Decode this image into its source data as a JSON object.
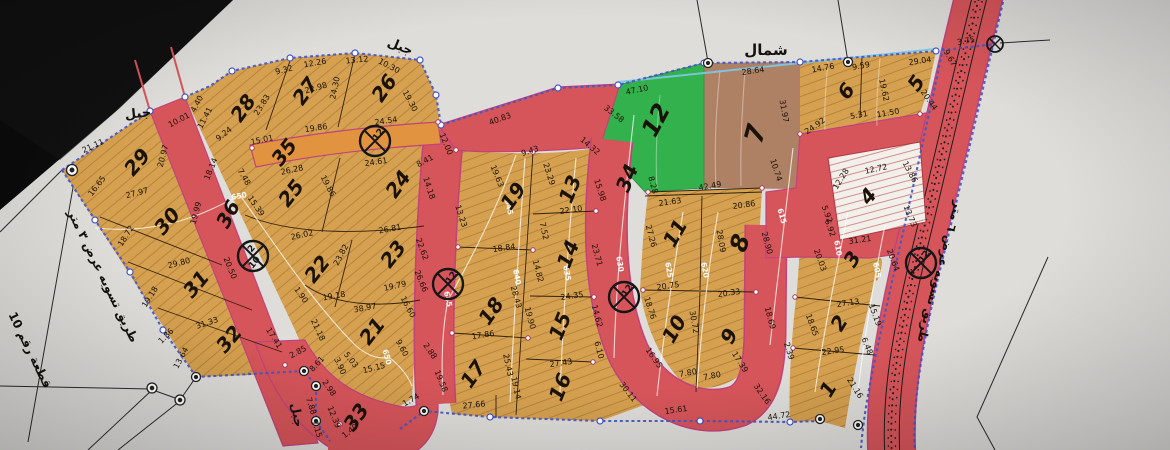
{
  "map": {
    "type": "cadastral-subdivision-plan",
    "north_label": "شمال",
    "colors": {
      "paper": "#deddda",
      "black_corner": "#0b0b0c",
      "plot_tan": "#d5a04f",
      "road_red": "#d6555a",
      "road_edge_magenta": "#c2427c",
      "road_orange": "#e2933f",
      "plot_green": "#33b14c",
      "plot_brown": "#ae8165",
      "plot_hatched_white": "#f3f0ec",
      "boundary_blue": "#4456c7",
      "contour_white": "#ffffff",
      "ink": "#1a1208"
    },
    "labels": [
      {
        "t": "شمال",
        "x": 766,
        "y": 50,
        "r": 0,
        "s": 15,
        "b": 1
      },
      {
        "t": "جبل",
        "x": 400,
        "y": 47,
        "r": 22,
        "s": 13,
        "b": 1
      },
      {
        "t": "جبل",
        "x": 138,
        "y": 114,
        "r": -6,
        "s": 13,
        "b": 1
      },
      {
        "t": "جبل",
        "x": 297,
        "y": 415,
        "r": 80,
        "s": 12,
        "b": 1
      },
      {
        "t": "طريق تسويه عرض ٣ متر",
        "x": 103,
        "y": 276,
        "r": 64,
        "s": 12,
        "b": 1
      },
      {
        "t": "قطعة رقم 10",
        "x": 30,
        "y": 350,
        "r": 64,
        "s": 12,
        "b": 1
      },
      {
        "t": "طريق تسويه عرض ٦ متر",
        "x": 940,
        "y": 272,
        "r": 105,
        "s": 12,
        "b": 1
      }
    ],
    "plots": [
      {
        "n": "1",
        "x": 828,
        "y": 389,
        "r": -58
      },
      {
        "n": "2",
        "x": 839,
        "y": 323,
        "r": -58
      },
      {
        "n": "3",
        "x": 852,
        "y": 259,
        "r": -58
      },
      {
        "n": "4",
        "x": 868,
        "y": 196,
        "r": -50
      },
      {
        "n": "5",
        "x": 916,
        "y": 83,
        "r": -55
      },
      {
        "n": "6",
        "x": 846,
        "y": 91,
        "r": -52
      },
      {
        "n": "7",
        "x": 756,
        "y": 134,
        "r": -75,
        "s": 26
      },
      {
        "n": "8",
        "x": 740,
        "y": 243,
        "r": -72,
        "s": 24
      },
      {
        "n": "9",
        "x": 729,
        "y": 336,
        "r": -62
      },
      {
        "n": "10",
        "x": 674,
        "y": 329,
        "r": -60
      },
      {
        "n": "11",
        "x": 675,
        "y": 233,
        "r": -60
      },
      {
        "n": "12",
        "x": 656,
        "y": 120,
        "r": -62,
        "s": 24
      },
      {
        "n": "13",
        "x": 570,
        "y": 189,
        "r": -68
      },
      {
        "n": "14",
        "x": 568,
        "y": 254,
        "r": -68
      },
      {
        "n": "15",
        "x": 560,
        "y": 326,
        "r": -68
      },
      {
        "n": "16",
        "x": 560,
        "y": 387,
        "r": -68
      },
      {
        "n": "17",
        "x": 473,
        "y": 374,
        "r": -55
      },
      {
        "n": "18",
        "x": 491,
        "y": 311,
        "r": -55
      },
      {
        "n": "19",
        "x": 513,
        "y": 196,
        "r": -55
      },
      {
        "n": "21",
        "x": 372,
        "y": 331,
        "r": -52
      },
      {
        "n": "22",
        "x": 317,
        "y": 269,
        "r": -52
      },
      {
        "n": "23",
        "x": 393,
        "y": 254,
        "r": -52
      },
      {
        "n": "24",
        "x": 398,
        "y": 184,
        "r": -55
      },
      {
        "n": "25",
        "x": 291,
        "y": 193,
        "r": -52
      },
      {
        "n": "26",
        "x": 384,
        "y": 88,
        "r": -55
      },
      {
        "n": "27",
        "x": 305,
        "y": 91,
        "r": -55
      },
      {
        "n": "28",
        "x": 243,
        "y": 108,
        "r": -55
      },
      {
        "n": "29",
        "x": 137,
        "y": 162,
        "r": -50
      },
      {
        "n": "30",
        "x": 167,
        "y": 221,
        "r": -50
      },
      {
        "n": "31",
        "x": 196,
        "y": 284,
        "r": -50
      },
      {
        "n": "32",
        "x": 229,
        "y": 339,
        "r": -50
      },
      {
        "n": "33",
        "x": 356,
        "y": 417,
        "r": -55
      },
      {
        "n": "34",
        "x": 627,
        "y": 178,
        "r": -68
      },
      {
        "n": "35",
        "x": 284,
        "y": 152,
        "r": -52
      },
      {
        "n": "36",
        "x": 228,
        "y": 214,
        "r": -62
      }
    ],
    "dims": [
      [
        "21.11",
        93,
        146,
        -25
      ],
      [
        "4.40",
        197,
        104,
        -62
      ],
      [
        "11.41",
        205,
        118,
        -62
      ],
      [
        "9.24",
        224,
        134,
        -38
      ],
      [
        "22.98",
        316,
        88,
        -16
      ],
      [
        "9.32",
        284,
        70,
        -14
      ],
      [
        "12.26",
        315,
        63,
        -10
      ],
      [
        "13.12",
        357,
        60,
        -6
      ],
      [
        "10.30",
        389,
        66,
        28
      ],
      [
        "24.30",
        335,
        88,
        -78
      ],
      [
        "23.83",
        262,
        105,
        -58
      ],
      [
        "19.30",
        410,
        101,
        62
      ],
      [
        "24.54",
        386,
        121,
        -8
      ],
      [
        "19.86",
        316,
        128,
        -8
      ],
      [
        "15.01",
        262,
        140,
        -12
      ],
      [
        "10.01",
        179,
        120,
        -28
      ],
      [
        "20.97",
        163,
        156,
        -75
      ],
      [
        "18.14",
        211,
        169,
        -68
      ],
      [
        "16.65",
        97,
        186,
        -52
      ],
      [
        "27.97",
        137,
        193,
        -14
      ],
      [
        "19.99",
        196,
        213,
        -75
      ],
      [
        "18.72",
        126,
        236,
        -58
      ],
      [
        "29.80",
        179,
        263,
        -14
      ],
      [
        "19.18",
        150,
        297,
        -58
      ],
      [
        "31.33",
        207,
        323,
        -18
      ],
      [
        "1.86",
        166,
        336,
        -45
      ],
      [
        "13.64",
        181,
        358,
        -62
      ],
      [
        "20.50",
        230,
        268,
        68
      ],
      [
        "26.28",
        292,
        170,
        -12
      ],
      [
        "15.39",
        256,
        206,
        55
      ],
      [
        "7.48",
        244,
        177,
        60
      ],
      [
        "19.86",
        328,
        186,
        62
      ],
      [
        "24.61",
        376,
        162,
        -8
      ],
      [
        "8.41",
        425,
        161,
        -28
      ],
      [
        "14.18",
        429,
        188,
        72
      ],
      [
        "26.02",
        302,
        235,
        -12
      ],
      [
        "26.81",
        390,
        229,
        -10
      ],
      [
        "23.82",
        341,
        255,
        -62
      ],
      [
        "22.62",
        422,
        249,
        70
      ],
      [
        "19.79",
        395,
        286,
        -12
      ],
      [
        "19.18",
        334,
        296,
        -10
      ],
      [
        "1.90",
        301,
        295,
        55
      ],
      [
        "21.18",
        318,
        330,
        65
      ],
      [
        "38.97",
        365,
        308,
        -10
      ],
      [
        "16.60",
        408,
        307,
        62
      ],
      [
        "9.60",
        402,
        348,
        62
      ],
      [
        "15.15",
        374,
        368,
        -14
      ],
      [
        "5.03",
        351,
        360,
        52
      ],
      [
        "2.85",
        298,
        352,
        -28
      ],
      [
        "8.61",
        317,
        364,
        -48
      ],
      [
        "3.90",
        340,
        366,
        65
      ],
      [
        "2.98",
        329,
        388,
        55
      ],
      [
        "7.88",
        311,
        406,
        72
      ],
      [
        "7.15",
        317,
        429,
        72
      ],
      [
        "12.39",
        334,
        417,
        68
      ],
      [
        "1.40",
        350,
        431,
        -38
      ],
      [
        "1.74",
        411,
        400,
        -30
      ],
      [
        "17.41",
        274,
        338,
        58
      ],
      [
        "40.83",
        500,
        119,
        -20
      ],
      [
        "12.00",
        446,
        144,
        68
      ],
      [
        "9.43",
        530,
        151,
        -18
      ],
      [
        "14.32",
        590,
        146,
        40
      ],
      [
        "23.29",
        549,
        174,
        72
      ],
      [
        "19.63",
        497,
        176,
        68
      ],
      [
        "13.23",
        461,
        216,
        72
      ],
      [
        "15.98",
        600,
        190,
        72
      ],
      [
        "22.10",
        571,
        210,
        -8
      ],
      [
        "7.52",
        544,
        231,
        78
      ],
      [
        "18.84",
        504,
        248,
        -8
      ],
      [
        "23.71",
        597,
        255,
        75
      ],
      [
        "14.82",
        538,
        271,
        75
      ],
      [
        "26.66",
        421,
        281,
        68
      ],
      [
        "28.43",
        516,
        297,
        75
      ],
      [
        "19.90",
        530,
        318,
        75
      ],
      [
        "24.35",
        572,
        296,
        -8
      ],
      [
        "14.62",
        597,
        316,
        75
      ],
      [
        "17.86",
        483,
        335,
        -8
      ],
      [
        "2.88",
        430,
        351,
        55
      ],
      [
        "25.43",
        508,
        365,
        78
      ],
      [
        "6.10",
        599,
        350,
        75
      ],
      [
        "27.43",
        561,
        363,
        -8
      ],
      [
        "19.58",
        441,
        381,
        68
      ],
      [
        "19.14",
        516,
        388,
        78
      ],
      [
        "16.95",
        654,
        358,
        55
      ],
      [
        "27.66",
        474,
        405,
        -6
      ],
      [
        "18.76",
        650,
        308,
        72
      ],
      [
        "20.75",
        668,
        286,
        -8
      ],
      [
        "20.33",
        729,
        293,
        -8
      ],
      [
        "30.72",
        694,
        322,
        80
      ],
      [
        "17.39",
        740,
        362,
        58
      ],
      [
        "7.80",
        688,
        373,
        -10
      ],
      [
        "7.80",
        712,
        376,
        -10
      ],
      [
        "15.61",
        676,
        410,
        -8
      ],
      [
        "30.11",
        628,
        392,
        52
      ],
      [
        "32.16",
        762,
        394,
        55
      ],
      [
        "44.72",
        779,
        416,
        -8
      ],
      [
        "2.39",
        789,
        351,
        72
      ],
      [
        "21.16",
        855,
        388,
        58
      ],
      [
        "22.95",
        833,
        351,
        -8
      ],
      [
        "6.48",
        867,
        346,
        68
      ],
      [
        "18.65",
        812,
        325,
        70
      ],
      [
        "15.19",
        875,
        315,
        70
      ],
      [
        "27.13",
        848,
        303,
        -8
      ],
      [
        "20.03",
        820,
        260,
        70
      ],
      [
        "20.64",
        893,
        260,
        70
      ],
      [
        "31.21",
        860,
        240,
        -8
      ],
      [
        "5.92",
        827,
        214,
        70
      ],
      [
        "13.73",
        910,
        216,
        68
      ],
      [
        "6.92",
        830,
        228,
        70
      ],
      [
        "12.72",
        876,
        169,
        -12
      ],
      [
        "13.86",
        910,
        172,
        62
      ],
      [
        "12.28",
        841,
        179,
        -58
      ],
      [
        "21.63",
        670,
        202,
        -8
      ],
      [
        "20.86",
        744,
        205,
        -8
      ],
      [
        "27.26",
        651,
        236,
        75
      ],
      [
        "28.09",
        721,
        241,
        80
      ],
      [
        "28.90",
        767,
        243,
        75
      ],
      [
        "42.49",
        710,
        186,
        -10
      ],
      [
        "8.28",
        653,
        185,
        75
      ],
      [
        "10.74",
        776,
        170,
        72
      ],
      [
        "31.97",
        784,
        111,
        80
      ],
      [
        "28.64",
        753,
        71,
        -8
      ],
      [
        "47.10",
        637,
        90,
        -12
      ],
      [
        "33.58",
        614,
        114,
        38
      ],
      [
        "14.76",
        823,
        68,
        -10
      ],
      [
        "9.59",
        861,
        66,
        -10
      ],
      [
        "29.04",
        920,
        61,
        -8
      ],
      [
        "19.62",
        884,
        90,
        78
      ],
      [
        "20.44",
        929,
        100,
        55
      ],
      [
        "5.31",
        859,
        115,
        -10
      ],
      [
        "11.50",
        888,
        113,
        -10
      ],
      [
        "24.92",
        815,
        126,
        -35
      ],
      [
        "9.67",
        950,
        58,
        60
      ],
      [
        "3.75",
        966,
        41,
        -10
      ],
      [
        "18.69",
        770,
        318,
        75
      ]
    ],
    "contour_labels": [
      [
        "650",
        239,
        196,
        -10
      ],
      [
        "650",
        387,
        357,
        75
      ],
      [
        "645",
        509,
        207,
        78
      ],
      [
        "645",
        448,
        299,
        78
      ],
      [
        "640",
        517,
        277,
        80
      ],
      [
        "635",
        567,
        273,
        80
      ],
      [
        "630",
        620,
        264,
        80
      ],
      [
        "625",
        669,
        270,
        80
      ],
      [
        "620",
        705,
        270,
        80
      ],
      [
        "615",
        782,
        216,
        75
      ],
      [
        "610",
        838,
        248,
        80
      ],
      [
        "605",
        877,
        270,
        80
      ]
    ],
    "road_markers": [
      {
        "x": 375,
        "y": 141,
        "t": "12"
      },
      {
        "x": 448,
        "y": 284,
        "t": "12"
      },
      {
        "x": 624,
        "y": 297,
        "t": "12"
      },
      {
        "x": 921,
        "y": 263,
        "t": "12"
      },
      {
        "x": 995,
        "y": 44,
        "t": "",
        "small": 1
      },
      {
        "x": 253,
        "y": 256,
        "t": "2",
        "b": "10"
      }
    ]
  }
}
